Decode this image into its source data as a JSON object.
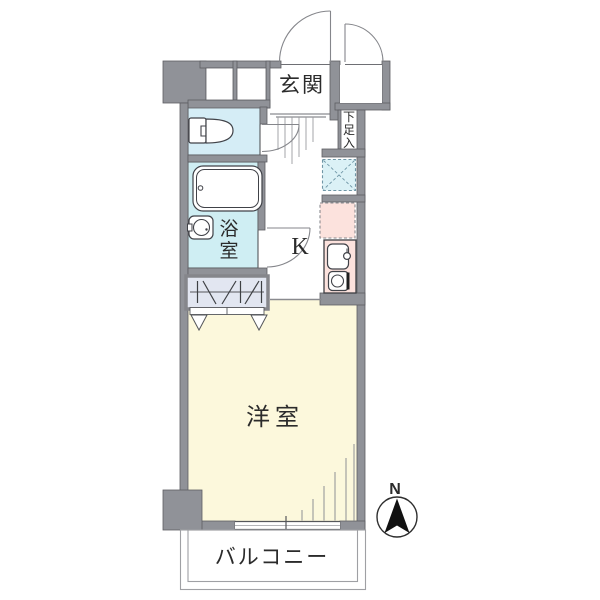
{
  "title": "apartment-floor-plan",
  "labels": {
    "entrance": "玄関",
    "shoe_box_chars": [
      "下",
      "足",
      "入"
    ],
    "bath_chars": [
      "浴",
      "室"
    ],
    "kitchen": "K",
    "western_room": "洋室",
    "balcony": "バルコニー",
    "compass_north": "N"
  },
  "rooms": [
    {
      "name": "genkan",
      "label": "玄関"
    },
    {
      "name": "shoe-box",
      "label": "下足入"
    },
    {
      "name": "toilet",
      "label": ""
    },
    {
      "name": "bathroom",
      "label": "浴室"
    },
    {
      "name": "kitchen",
      "label": "K"
    },
    {
      "name": "closet",
      "label": ""
    },
    {
      "name": "western-room",
      "label": "洋室"
    },
    {
      "name": "balcony",
      "label": "バルコニー"
    }
  ],
  "colors": {
    "wall_gray": "#909298",
    "toilet_room_fill": "#d5edf6",
    "bathroom_fill": "#cfeef3",
    "washer_space_fill": "#dbf1f6",
    "kitchen_counter_fill": "#fce2dd",
    "fridge_space_fill": "#fce2dd",
    "closet_fill": "#e2e6f1",
    "western_room_fill": "#fcf8dc",
    "outline_dark": "#404248",
    "text": "#2b2b2b",
    "compass_arrow": "#111111"
  }
}
